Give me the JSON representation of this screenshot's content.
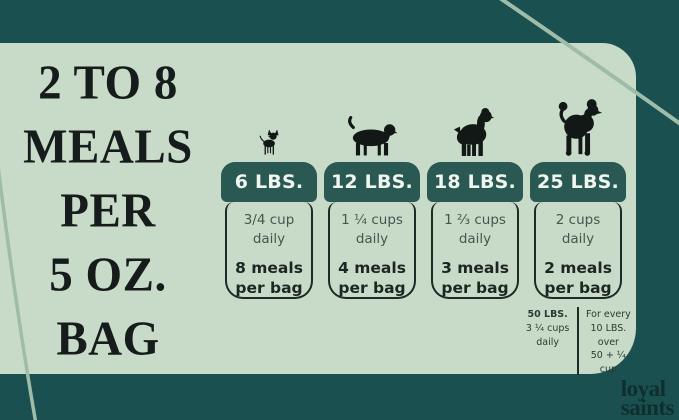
{
  "headline": {
    "lines": [
      "2 TO 8",
      "MEALS",
      "PER",
      "5 OZ.",
      "BAG"
    ]
  },
  "columns": [
    {
      "dog": "chihuahua-icon",
      "weight": "6 LBS.",
      "daily_amount": "3/4 cup",
      "daily_label": "daily",
      "meals": "8 meals",
      "meals_label": "per bag"
    },
    {
      "dog": "dachshund-icon",
      "weight": "12 LBS.",
      "daily_amount": "1 ¼ cups",
      "daily_label": "daily",
      "meals": "4 meals",
      "meals_label": "per bag"
    },
    {
      "dog": "spaniel-icon",
      "weight": "18 LBS.",
      "daily_amount": "1 ⅔ cups",
      "daily_label": "daily",
      "meals": "3 meals",
      "meals_label": "per bag"
    },
    {
      "dog": "poodle-icon",
      "weight": "25 LBS.",
      "daily_amount": "2 cups",
      "daily_label": "daily",
      "meals": "2 meals",
      "meals_label": "per bag"
    }
  ],
  "footnote": {
    "left": [
      "50 LBS.",
      "3 ¼ cups",
      "daily"
    ],
    "right": [
      "For every",
      "10 LBS. over",
      "50 + ¼ cup"
    ]
  },
  "logo": {
    "line1": "loyal",
    "line2": "saints"
  },
  "colors": {
    "frame": "#1a504f",
    "panel": "#c8dbc9",
    "header_pill": "#2a5852",
    "outline": "#1e2a25",
    "accent_curve": "#9fbca9",
    "headline_text": "#161c1b",
    "header_text": "#eff5ef"
  },
  "chart_data": {
    "type": "table",
    "title": "2 TO 8 MEALS PER 5 OZ. BAG",
    "categories": [
      "6 LBS.",
      "12 LBS.",
      "18 LBS.",
      "25 LBS."
    ],
    "series": [
      {
        "name": "cups daily",
        "values": [
          "3/4 cup",
          "1 ¼ cups",
          "1 ⅔ cups",
          "2 cups"
        ]
      },
      {
        "name": "meals per bag",
        "values": [
          8,
          4,
          3,
          2
        ]
      }
    ],
    "footnote": "50 LBS. 3 ¼ cups daily — For every 10 LBS. over 50 + ¼ cup",
    "legend_position": "none",
    "grid": false
  }
}
